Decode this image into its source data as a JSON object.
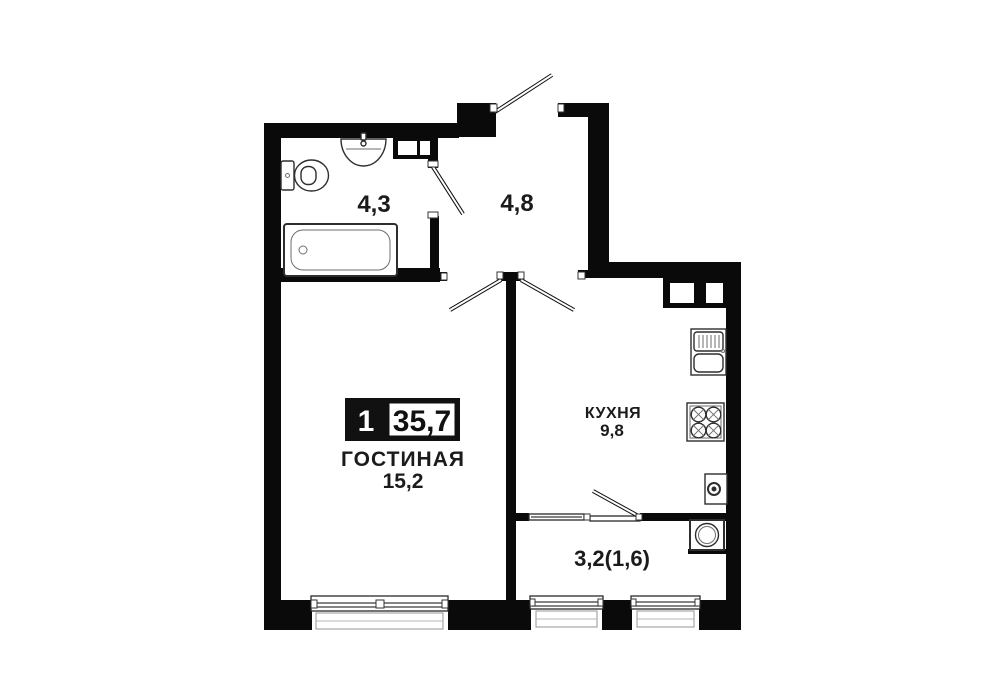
{
  "floor_plan": {
    "title_badge": {
      "room_count": "1",
      "total_area": "35,7"
    },
    "rooms": {
      "bathroom": {
        "area": "4,3"
      },
      "hallway": {
        "area": "4,8"
      },
      "living_room": {
        "name": "ГОСТИНАЯ",
        "area": "15,2"
      },
      "kitchen": {
        "name": "КУХНЯ",
        "area": "9,8"
      },
      "balcony": {
        "area": "3,2(1,6)"
      }
    },
    "colors": {
      "walls": "#0a0a0a",
      "background": "#ffffff",
      "fixtures": "#2e2e2e"
    }
  }
}
